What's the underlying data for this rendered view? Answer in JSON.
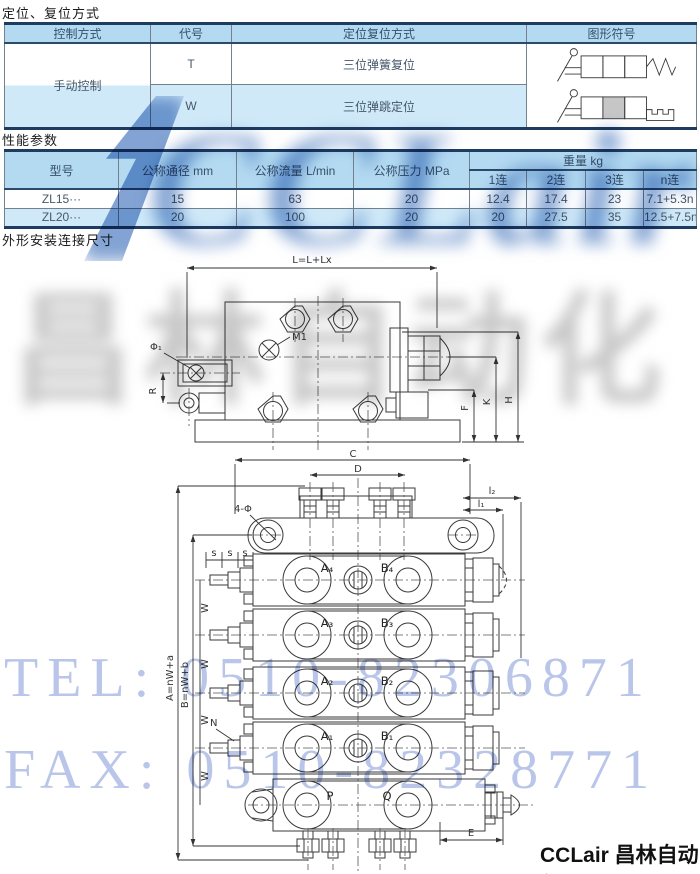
{
  "colors": {
    "header_blue": "#b3daf1",
    "row_blue": "#cfe9f8",
    "border_navy": "#1e3c60",
    "watermark_blue": "#4d7cc0",
    "watermark_lightblue": "#b6c3e8",
    "watermark_grey": "#8f8f8f"
  },
  "watermarks": {
    "brand": "CCLair",
    "company": "昌林自动化",
    "tel": "TEL: 0510-82306871",
    "fax": "FAX: 0510-82328771"
  },
  "footer": {
    "brand": "CCLair 昌林自动化"
  },
  "positioning": {
    "title": "定位、复位方式",
    "headers": [
      "控制方式",
      "代号",
      "定位复位方式",
      "图形符号"
    ],
    "control_method": "手动控制",
    "rows": [
      {
        "code": "T",
        "method": "三位弹簧复位",
        "symbol": "three-position-spring-return"
      },
      {
        "code": "W",
        "method": "三位弹跳定位",
        "symbol": "three-position-detent"
      }
    ]
  },
  "performance": {
    "title": "性能参数",
    "headers": {
      "model": "型号",
      "diameter": "公称通径 mm",
      "flow": "公称流量 L/min",
      "pressure": "公称压力 MPa",
      "weight": "重量 kg",
      "weight_cols": [
        "1连",
        "2连",
        "3连",
        "n连"
      ]
    },
    "rows": [
      {
        "model": "ZL15···",
        "diameter": "15",
        "flow": "63",
        "pressure": "20",
        "w1": "12.4",
        "w2": "17.4",
        "w3": "23",
        "wn": "7.1+5.3n"
      },
      {
        "model": "ZL20···",
        "diameter": "20",
        "flow": "100",
        "pressure": "20",
        "w1": "20",
        "w2": "27.5",
        "w3": "35",
        "wn": "12.5+7.5n"
      }
    ]
  },
  "dims": {
    "title": "外形安装连接尺寸",
    "side_view": {
      "length": "L=L+Lx",
      "m1": "M1",
      "phi1": "Φ₁",
      "r": "R",
      "f": "F",
      "k": "K",
      "h": "H"
    },
    "front_view": {
      "c": "C",
      "d": "D",
      "l2": "l₂",
      "l1": "l₁",
      "four_phi": "4-Φ",
      "s": "s",
      "w": "W",
      "n": "N",
      "e": "E",
      "a_formula": "A=nW+a",
      "b_formula": "B=nW+b",
      "sections": [
        {
          "a": "A₄",
          "b": "B₄"
        },
        {
          "a": "A₃",
          "b": "B₃"
        },
        {
          "a": "A₂",
          "b": "B₂"
        },
        {
          "a": "A₁",
          "b": "B₁"
        }
      ],
      "p": "P",
      "q": "Q"
    }
  }
}
